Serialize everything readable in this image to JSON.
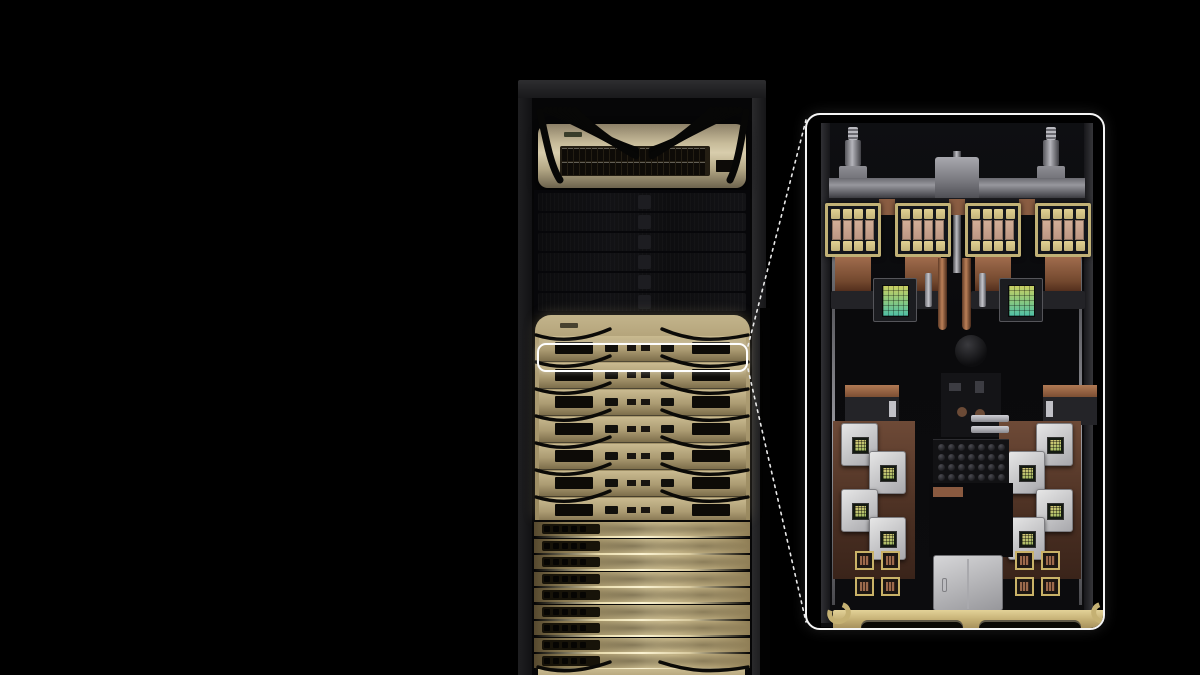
{
  "scene": {
    "description": "3D render of a liquid-cooled GPU server rack on a black backdrop, with a white outline on one compute tray connected by dashed leader lines to a magnified top-down callout of that tray",
    "background_color": "#000000"
  },
  "colors": {
    "rack_cap": "#232325",
    "rack_pillar": "#1a1a1c",
    "switch_faceplate": "#c7bb9a",
    "cable_black": "#070706",
    "blank_panel": "#101013",
    "tray_gold": "#ab9b72",
    "tray_gold_bright": "#cfc098",
    "tray_slot_dark": "#0d0b07",
    "blade_gold": "#c9ba8e",
    "highlight_stroke": "#ffffff",
    "callout_border": "#f5f5f5",
    "callout_background": "#000000",
    "metal_gray": "#97979d",
    "copper": "#96654a",
    "gpu_frame_gold": "#c1b176",
    "hbm_gold": "#d6c688",
    "gpu_die": "#c9a28b",
    "cpu_die_top": "#c9cf63",
    "cpu_die_bottom": "#4fbfa6",
    "nic_white": "#dedede",
    "ssd_silver": "#c9c9cd",
    "front_bar_gold": "#c2ae74"
  },
  "rack": {
    "top_switch": {
      "port_rows": 2,
      "ports_per_row": 24,
      "logo": "nvidia-logo-mark",
      "cable_bundles": 2
    },
    "blank_panel_rows": 6,
    "compute_tray_rows": 7,
    "highlighted_tray_row": 2,
    "nvlink_blade_rows": 9,
    "blade_ports_per_row": 5,
    "bottom_tray_visible": true
  },
  "callout": {
    "coolant_posts": 2,
    "gpu_packages": 4,
    "hbm_stacks_per_gpu": 8,
    "gpu_die_strips_per_package": 4,
    "cpu_modules": 2,
    "copper_pipes": 2,
    "nic_modules_per_side": 4,
    "bga_chips_per_side": 4,
    "capacitor_rows": 4,
    "capacitor_cols": 7,
    "latches": 2,
    "handle_cutouts": 2
  }
}
